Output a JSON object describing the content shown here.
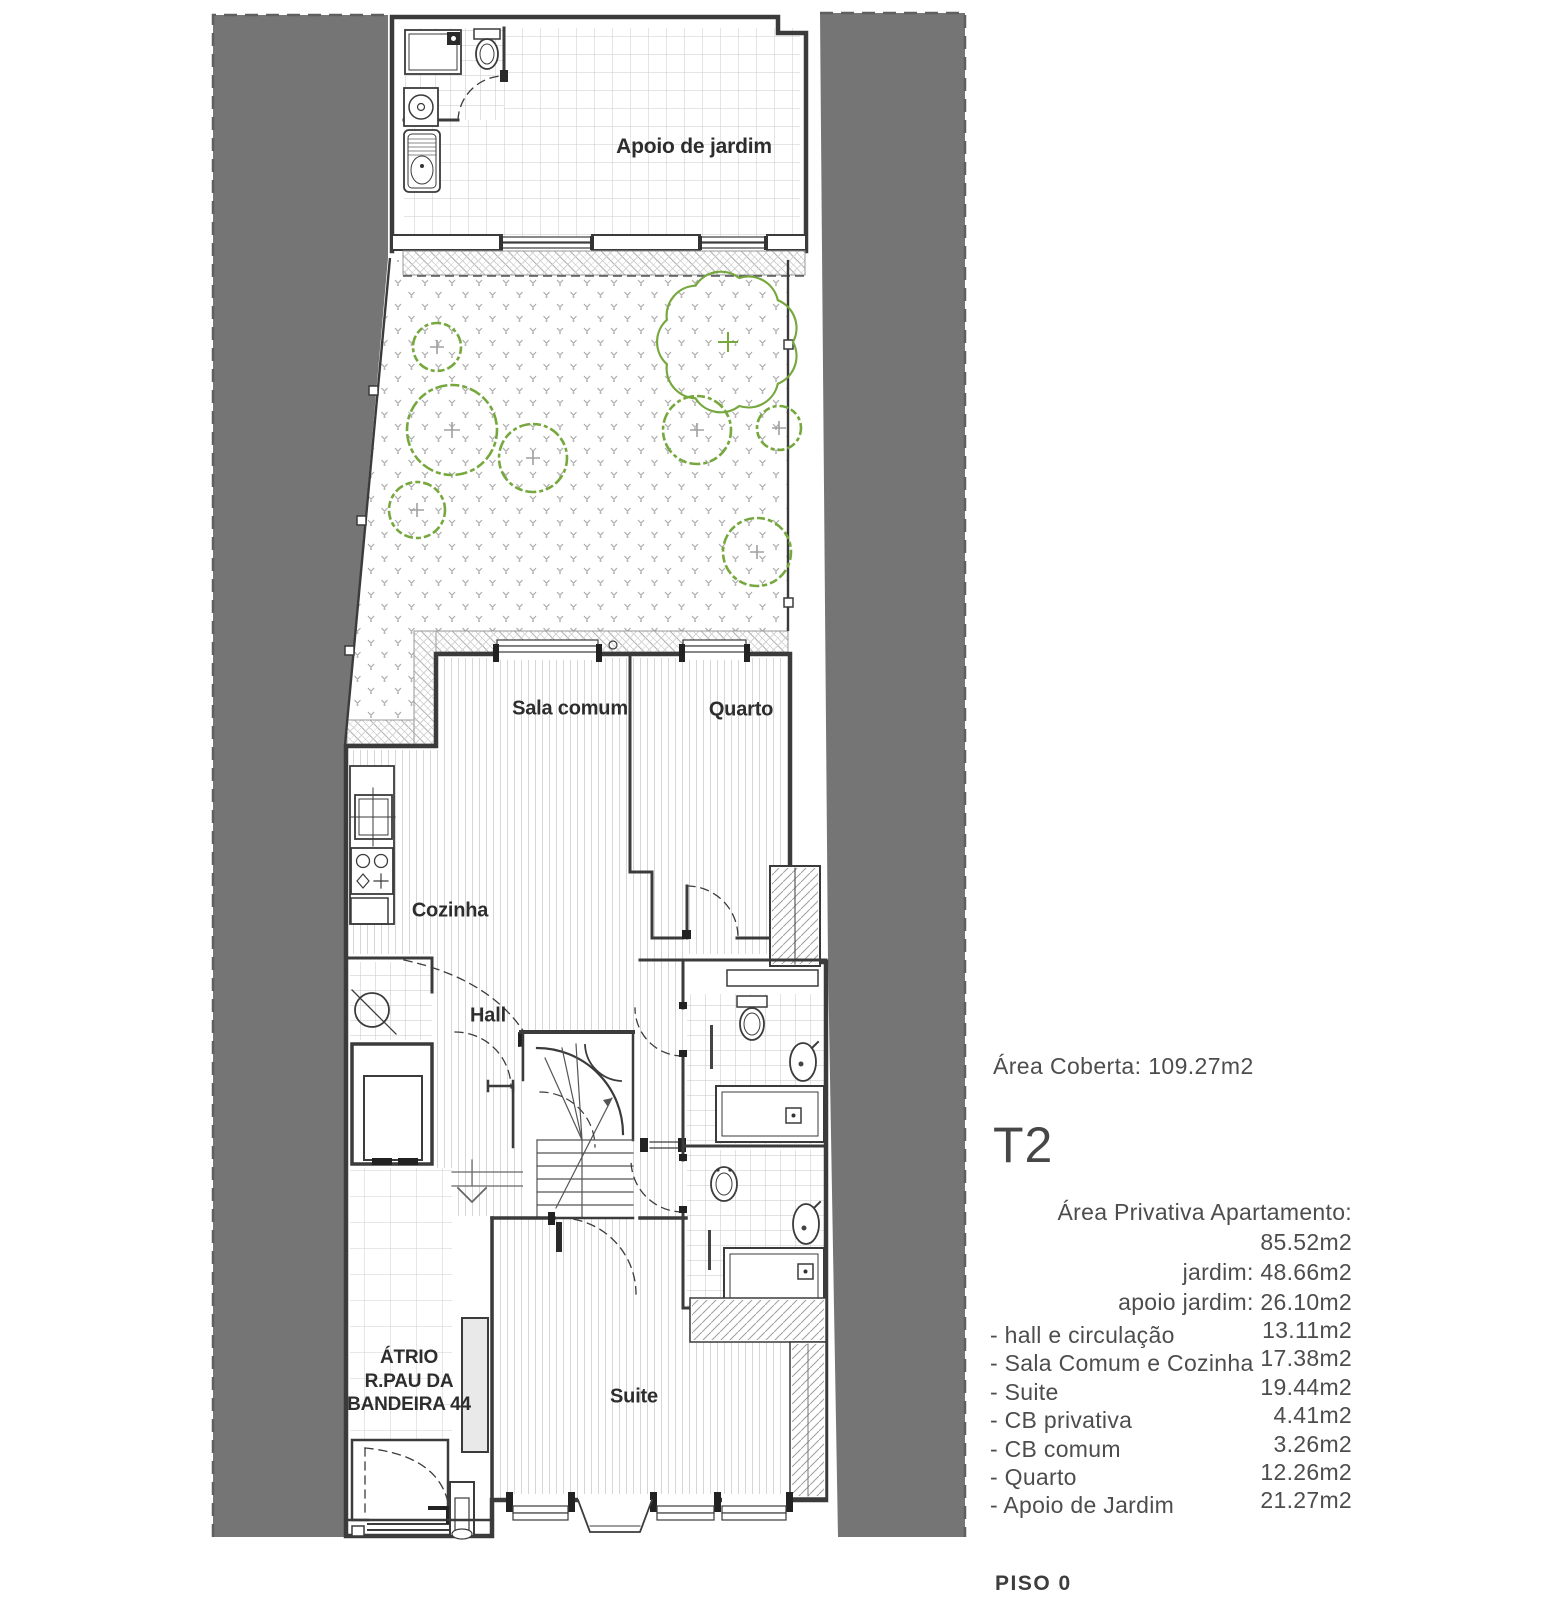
{
  "colors": {
    "band-gray": "#757575",
    "wall": "#3b3b3b",
    "shrub-green": "#76a83e"
  },
  "plan": {
    "labels": [
      {
        "id": "apoio-de-jardim",
        "text": "Apoio de jardim"
      },
      {
        "id": "sala-comum",
        "text": "Sala comum"
      },
      {
        "id": "quarto",
        "text": "Quarto"
      },
      {
        "id": "cozinha",
        "text": "Cozinha"
      },
      {
        "id": "hall",
        "text": "Hall"
      },
      {
        "id": "suite",
        "text": "Suite"
      }
    ],
    "atrio": {
      "line1": "ÁTRIO",
      "line2": "R.PAU DA",
      "line3": "BANDEIRA 44"
    }
  },
  "info": {
    "area_coberta_label": "Área Coberta:",
    "area_coberta_value": "109.27m2",
    "unit_type": "T2",
    "private_areas": [
      {
        "label": "Área Privativa Apartamento:",
        "value": "85.52m2"
      },
      {
        "label": "jardim:",
        "value": "48.66m2"
      },
      {
        "label": "apoio jardim:",
        "value": "26.10m2"
      }
    ],
    "room_areas": [
      {
        "label": "- hall e circulação",
        "value": "13.11m2"
      },
      {
        "label": "- Sala Comum e Cozinha",
        "value": "17.38m2"
      },
      {
        "label": "- Suite",
        "value": "19.44m2"
      },
      {
        "label": "- CB privativa",
        "value": "4.41m2"
      },
      {
        "label": "- CB comum",
        "value": "3.26m2"
      },
      {
        "label": "- Quarto",
        "value": "12.26m2"
      },
      {
        "label": "- Apoio de Jardim",
        "value": "21.27m2"
      }
    ],
    "floor_label": "PISO 0"
  }
}
